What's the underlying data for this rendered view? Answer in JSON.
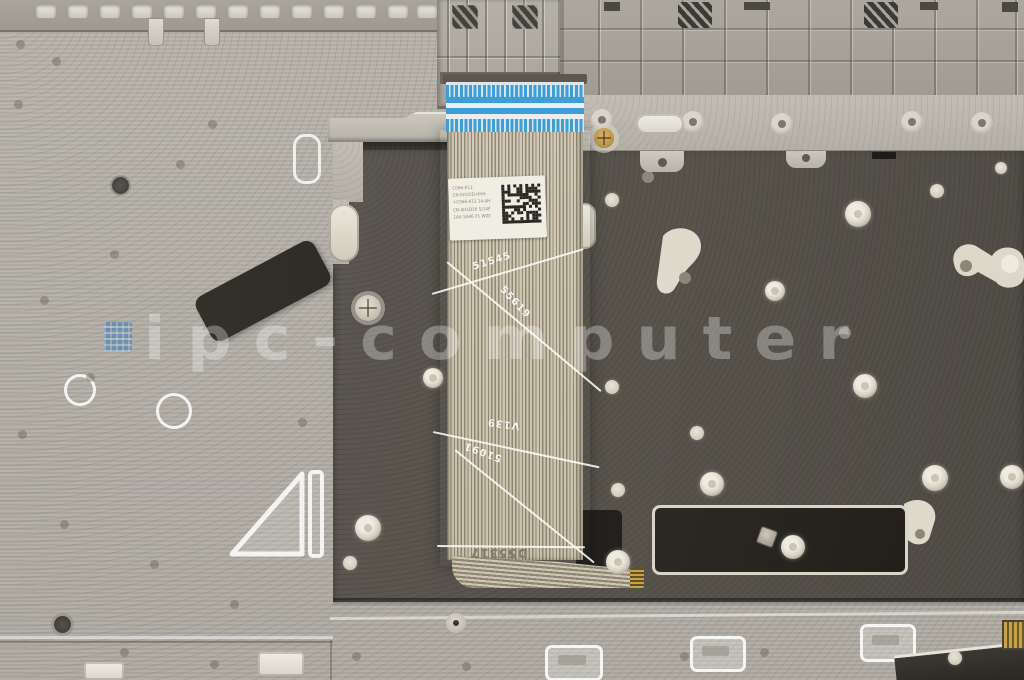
{
  "meta": {
    "alt": "Internal view of a laptop palmrest top case with dark keyboard backplate and keyboard ribbon cable with blue connector"
  },
  "watermark": {
    "text": "ipc-computer"
  },
  "cable": {
    "markings": {
      "m1": "51545",
      "m2": "55619",
      "m3": "V139",
      "m4": "51091",
      "m5": "D55317"
    },
    "label": {
      "lines": {
        "l1": "C066-K13",
        "l2": "CN-0H1DD-HHH",
        "l3": "+C066-K13 14-4H",
        "l4": "CN-4H1D16 5/14P",
        "l5": "1AA 5A46 P1 W00"
      }
    }
  },
  "colors": {
    "base_silver": "#b7b3ab",
    "plastic_rail": "#a9a59c",
    "keyboard_plate": "#57534b",
    "ffc_blue": "#3f9ed7",
    "cable_beige": "#d2cab6",
    "sticker_black": "#2e2c27",
    "label_white": "#f0ede3",
    "brass_screw": "#c09a4a",
    "logo_blue": "#3c79b5"
  }
}
